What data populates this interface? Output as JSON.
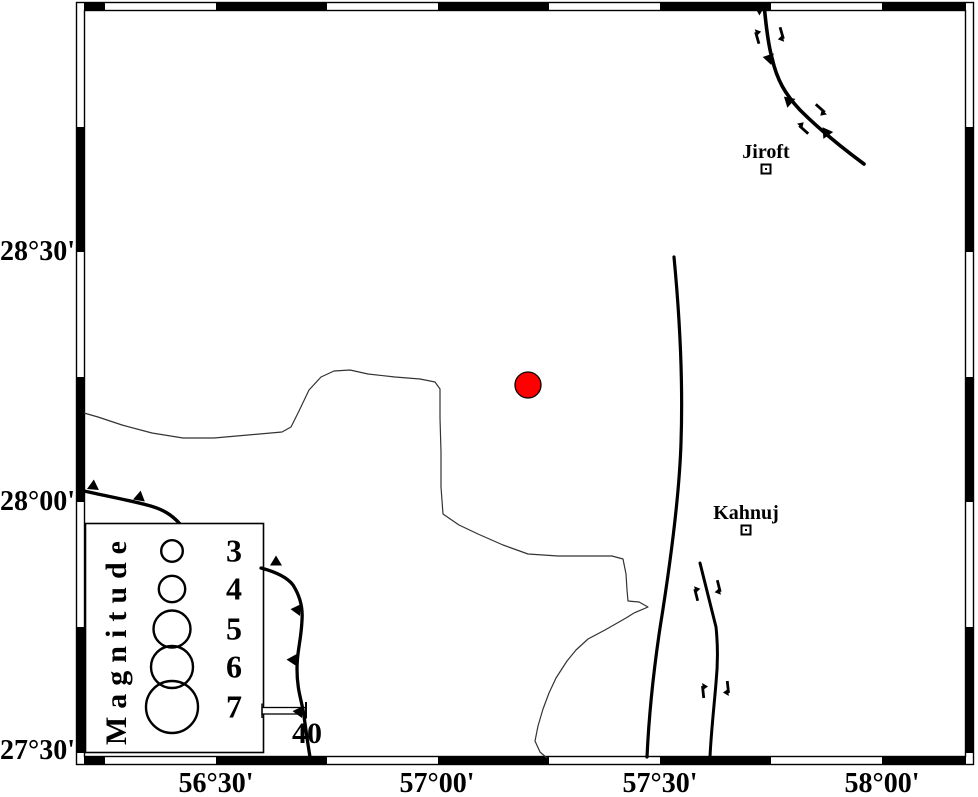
{
  "colors": {
    "ink": "#000000",
    "epicenter_fill": "#ff0000",
    "river": "#333333",
    "paper": "#ffffff"
  },
  "map": {
    "frame": {
      "outer": [
        76.5,
        2.5,
        897,
        762
      ],
      "inner": [
        84.5,
        10.5,
        881,
        746
      ],
      "band_thickness": 7,
      "x_black_segments": [
        [
          84,
          105
        ],
        [
          216,
          327
        ],
        [
          438,
          549
        ],
        [
          660,
          771
        ],
        [
          882,
          966
        ]
      ],
      "y_black_segments": [
        [
          127,
          252
        ],
        [
          377,
          502
        ],
        [
          627,
          753
        ]
      ]
    },
    "axis": {
      "y_labels": [
        {
          "text": "28°30'",
          "y": 252
        },
        {
          "text": "28°00'",
          "y": 502
        },
        {
          "text": "27°30'",
          "y": 751
        }
      ],
      "x_labels": [
        {
          "text": "56°30'",
          "x": 216
        },
        {
          "text": "57°00'",
          "x": 437
        },
        {
          "text": "57°30'",
          "x": 660
        },
        {
          "text": "58°00'",
          "x": 882
        }
      ]
    },
    "cities": [
      {
        "name": "Jiroft",
        "label_x": 766,
        "label_y": 152,
        "marker_x": 766,
        "marker_y": 169
      },
      {
        "name": "Kahnuj",
        "label_x": 746,
        "label_y": 513,
        "marker_x": 746,
        "marker_y": 530
      }
    ],
    "epicenter": {
      "x": 528,
      "y": 385,
      "r": 13
    },
    "river": {
      "points": [
        [
          84,
          413
        ],
        [
          98,
          417
        ],
        [
          122,
          425
        ],
        [
          152,
          433
        ],
        [
          183,
          438
        ],
        [
          214,
          438
        ],
        [
          248,
          435
        ],
        [
          282,
          432
        ],
        [
          291,
          427
        ],
        [
          299,
          411
        ],
        [
          309,
          390
        ],
        [
          321,
          377
        ],
        [
          334,
          371
        ],
        [
          350,
          370
        ],
        [
          368,
          374
        ],
        [
          395,
          377
        ],
        [
          420,
          379
        ],
        [
          435,
          382
        ],
        [
          440,
          389
        ],
        [
          440,
          418
        ],
        [
          441,
          452
        ],
        [
          441,
          487
        ],
        [
          443,
          514
        ],
        [
          459,
          525
        ],
        [
          478,
          534
        ],
        [
          503,
          545
        ],
        [
          528,
          554
        ],
        [
          558,
          556
        ],
        [
          590,
          556
        ],
        [
          612,
          556
        ],
        [
          623,
          559
        ],
        [
          626,
          574
        ],
        [
          627,
          590
        ],
        [
          628,
          601
        ],
        [
          639,
          602
        ],
        [
          648,
          607
        ],
        [
          634,
          613
        ],
        [
          626,
          618
        ],
        [
          605,
          630
        ],
        [
          588,
          639
        ],
        [
          576,
          650
        ],
        [
          567,
          661
        ],
        [
          556,
          678
        ],
        [
          549,
          693
        ],
        [
          543,
          709
        ],
        [
          538,
          726
        ],
        [
          535,
          741
        ],
        [
          540,
          752
        ],
        [
          547,
          758
        ]
      ]
    },
    "faults_under_legend": [
      {
        "name": "thrust-fault-west-upper",
        "d": "M 84,491 C 106,496 128,500 147,505 C 163,509 172,515 180,524",
        "width": 3.4,
        "teeth": [
          {
            "x": 93,
            "y": 489,
            "rot": 5
          },
          {
            "x": 139,
            "y": 500,
            "rot": 10
          }
        ]
      }
    ],
    "faults": [
      {
        "name": "thrust-fault-west-lower",
        "d": "M 261,568 C 276,572 287,577 293,585 C 300,596 303,607 302,620 C 301,642 297,650 297,669 C 297,691 302,701 304,716 C 306,731 308,745 310,757",
        "width": 3.3,
        "teeth": [
          {
            "x": 276,
            "y": 565,
            "rot": 0
          },
          {
            "x": 300,
            "y": 610,
            "rot": -85
          },
          {
            "x": 296,
            "y": 660,
            "rot": -88
          },
          {
            "x": 302,
            "y": 712,
            "rot": -85
          }
        ]
      },
      {
        "name": "main-fault",
        "d": "M 674,257 C 680,320 683,385 681,443 C 679,503 669,572 660,628 C 654,668 649,714 647,757",
        "width": 3.2
      },
      {
        "name": "kahnuj-fault",
        "d": "M 700,563 L 716,627 C 718,646 718,663 716,683 C 714,707 711,734 710,757",
        "width": 3,
        "arrows": [
          {
            "x": 696,
            "y": 594,
            "rot": -14
          },
          {
            "x": 719,
            "y": 587,
            "rot": 166
          },
          {
            "x": 703,
            "y": 691,
            "rot": -6
          },
          {
            "x": 728,
            "y": 688,
            "rot": 174
          }
        ]
      },
      {
        "name": "thrust-fault-northeast",
        "d": "M 764,4 C 766,26 768,44 772,58 C 777,80 785,94 800,110 C 817,127 841,147 864,164",
        "width": 3.6,
        "teeth": [
          {
            "x": 762,
            "y": 10,
            "rot": -60
          },
          {
            "x": 772,
            "y": 59,
            "rot": -78
          },
          {
            "x": 791,
            "y": 103,
            "rot": -48
          },
          {
            "x": 828,
            "y": 135,
            "rot": -35
          }
        ],
        "arrows": [
          {
            "x": 757,
            "y": 37,
            "rot": -16
          },
          {
            "x": 782,
            "y": 34,
            "rot": 164
          },
          {
            "x": 803,
            "y": 129,
            "rot": -48
          },
          {
            "x": 821,
            "y": 109,
            "rot": 132
          }
        ]
      }
    ],
    "scale_bar": {
      "x": 262,
      "y": 707.5,
      "w": 44,
      "h": 6.5,
      "label": "40"
    }
  },
  "legend": {
    "title": "Magnitude",
    "box": {
      "x": 85.5,
      "y": 523.5,
      "w": 178,
      "h": 229
    },
    "circle_cx": 172,
    "items": [
      {
        "magnitude": "3",
        "r": 10.8,
        "cy": 551
      },
      {
        "magnitude": "4",
        "r": 13.2,
        "cy": 589
      },
      {
        "magnitude": "5",
        "r": 18.5,
        "cy": 629
      },
      {
        "magnitude": "6",
        "r": 21.0,
        "cy": 667
      },
      {
        "magnitude": "7",
        "r": 26.0,
        "cy": 707
      }
    ]
  }
}
